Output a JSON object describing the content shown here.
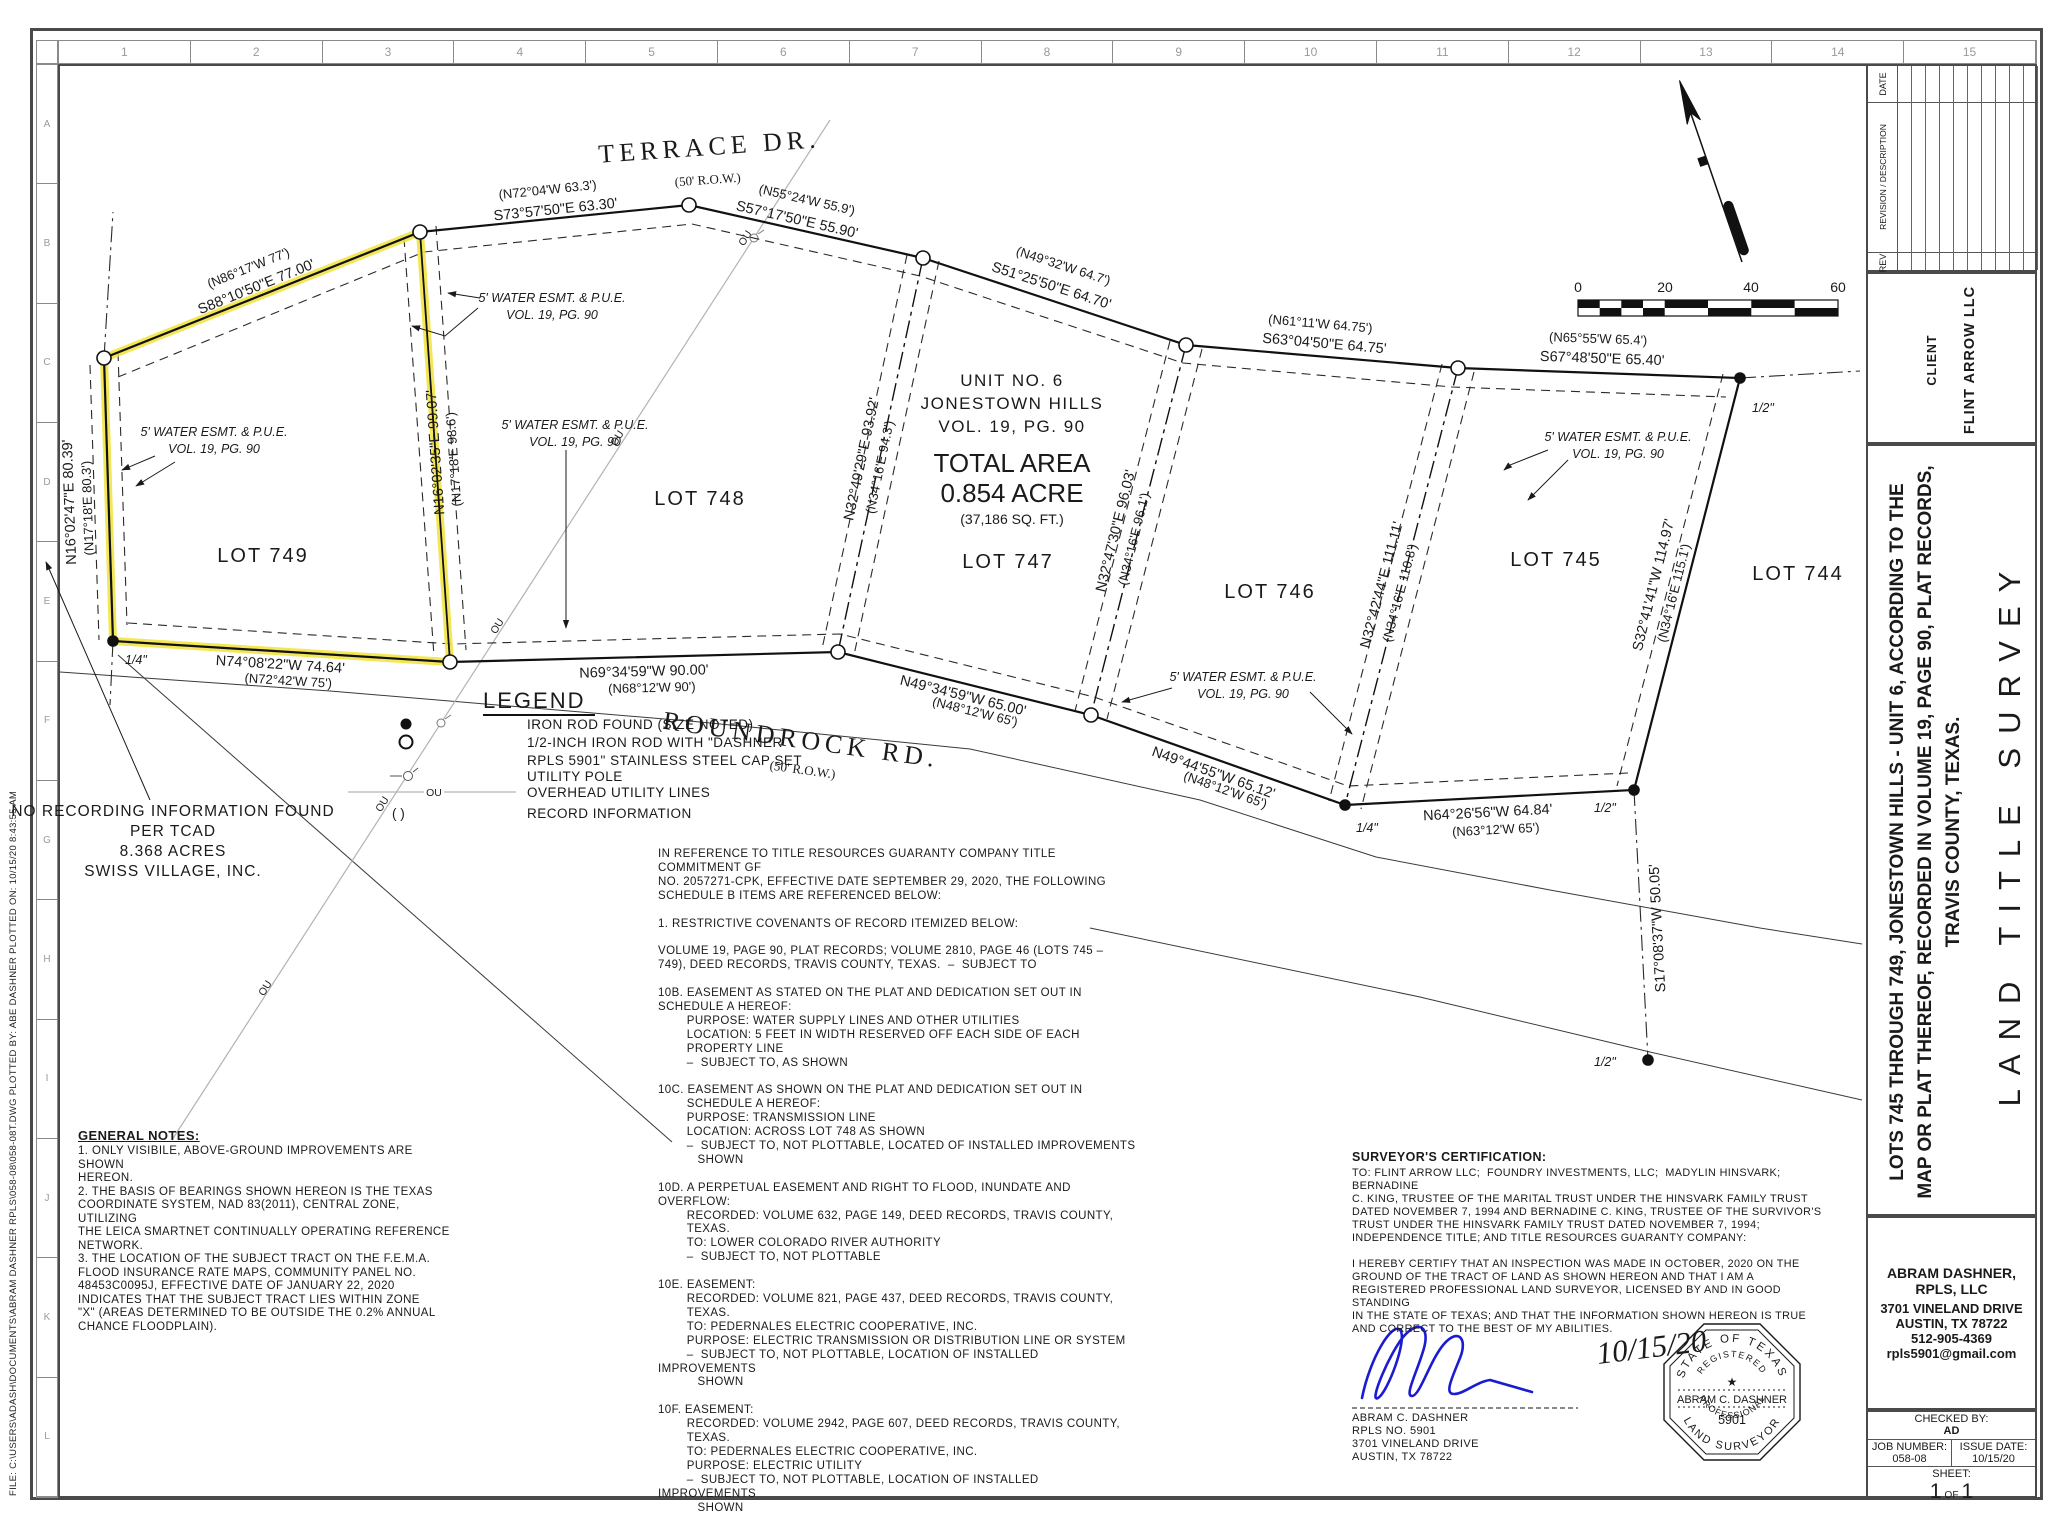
{
  "frame": {
    "margin_note": "FILE: C:\\USERS\\ADASH\\DOCUMENTS\\ABRAM DASHNER RPLS\\058-08\\058-08T.DWG      PLOTTED BY: ABE DASHNER      PLOTTED ON: 10/15/20  8:43:55 AM",
    "ruler_cols": [
      "1",
      "2",
      "3",
      "4",
      "5",
      "6",
      "7",
      "8",
      "9",
      "10",
      "11",
      "12",
      "13",
      "14",
      "15"
    ],
    "ruler_rows": [
      "A",
      "B",
      "C",
      "D",
      "E",
      "F",
      "G",
      "H",
      "I",
      "J",
      "K",
      "L"
    ]
  },
  "sidebar": {
    "revision": {
      "rev": "REV",
      "desc": "REVISION / DESCRIPTION",
      "date": "DATE"
    },
    "client_label": "CLIENT",
    "client_name": "FLINT ARROW LLC",
    "title_lines": [
      "LOTS 745 THROUGH 749, JONESTOWN HILLS - UNIT 6, ACCORDING TO THE",
      "MAP OR PLAT THEREOF, RECORDED IN VOLUME 19, PAGE 90, PLAT RECORDS,",
      "TRAVIS COUNTY, TEXAS."
    ],
    "survey_type": "LAND TITLE SURVEY",
    "firm": {
      "name": "ABRAM DASHNER, RPLS, LLC",
      "addr1": "3701 VINELAND DRIVE",
      "addr2": "AUSTIN, TX 78722",
      "phone": "512-905-4369",
      "email": "rpls5901@gmail.com"
    },
    "info": {
      "checked_label": "CHECKED BY:",
      "checked": "AD",
      "job_label": "JOB NUMBER:",
      "job": "058-08",
      "issue_label": "ISSUE DATE:",
      "issue": "10/15/20",
      "sheet_label": "SHEET:",
      "sheet_no": "1",
      "sheet_of": "OF",
      "sheet_total": "1"
    }
  },
  "plat": {
    "roads": {
      "terrace": "TERRACE DR.",
      "roundrock": "ROUNDROCK RD.",
      "row": "(50' R.O.W.)"
    },
    "unit": [
      "UNIT NO. 6",
      "JONESTOWN HILLS",
      "VOL. 19, PG. 90"
    ],
    "area": {
      "l1": "TOTAL AREA",
      "l2": "0.854 ACRE",
      "l3": "(37,186 SQ. FT.)"
    },
    "lots": {
      "l749": "LOT 749",
      "l748": "LOT 748",
      "l747": "LOT 747",
      "l746": "LOT 746",
      "l745": "LOT 745",
      "l744": "LOT 744"
    },
    "esmt": {
      "l1": "5' WATER ESMT. & P.U.E.",
      "l2": "VOL. 19, PG. 90"
    },
    "markers": {
      "q": "1/4\"",
      "h": "1/2\""
    },
    "ou": "OU",
    "no_rec": [
      "NO RECORDING INFORMATION FOUND",
      "PER TCAD",
      "8.368 ACRES",
      "SWISS VILLAGE, INC."
    ],
    "bearings": [
      {
        "m": "S88°10'50\"E  77.00'",
        "r": "(N86°17'W  77')"
      },
      {
        "m": "S73°57'50\"E  63.30'",
        "r": "(N72°04'W  63.3')"
      },
      {
        "m": "S57°17'50\"E  55.90'",
        "r": "(N55°24'W  55.9')"
      },
      {
        "m": "S51°25'50\"E  64.70'",
        "r": "(N49°32'W  64.7')"
      },
      {
        "m": "S63°04'50\"E  64.75'",
        "r": "(N61°11'W  64.75')"
      },
      {
        "m": "S67°48'50\"E  65.40'",
        "r": "(N65°55'W  65.4')"
      },
      {
        "m": "S32°41'41\"W  114.97'",
        "r": "(N34°16'E  115.1')"
      },
      {
        "m": "N64°26'56\"W  64.84'",
        "r": "(N63°12'W  65')"
      },
      {
        "m": "N49°44'55\"W  65.12'",
        "r": "(N48°12'W  65')"
      },
      {
        "m": "N49°34'59\"W  65.00'",
        "r": "(N48°12'W  65')"
      },
      {
        "m": "N69°34'59\"W  90.00'",
        "r": "(N68°12'W  90')"
      },
      {
        "m": "N74°08'22\"W  74.64'",
        "r": "(N72°42'W  75')"
      },
      {
        "m": "N16°02'47\"E  80.39'",
        "r": "(N17°18'E  80.3')"
      },
      {
        "m": "N16°02'35\"E  99.07'",
        "r": "(N17°18'E  98.6')"
      },
      {
        "m": "N32°49'29\"E  93.92'",
        "r": "(N34°16'E  94.3')"
      },
      {
        "m": "N32°47'30\"E  96.03'",
        "r": "(N34°16'E  96.1')"
      },
      {
        "m": "N32°42'44\"E  111.11'",
        "r": "(N34°16'E  110.8')"
      },
      {
        "m": "S17°08'37\"W  50.05'",
        "r": ""
      }
    ]
  },
  "legend": {
    "title": "LEGEND",
    "i0": "IRON ROD FOUND (SIZE NOTED)",
    "i1a": "1/2-INCH IRON ROD WITH \"DASHNER",
    "i1b": "RPLS 5901\" STAINLESS STEEL CAP SET",
    "i2": "UTILITY POLE",
    "i3": "OVERHEAD UTILITY LINES",
    "i4": "RECORD INFORMATION",
    "rec_sym": "(   )"
  },
  "notes": {
    "general_title": "GENERAL NOTES:",
    "general": "1. ONLY VISIBILE, ABOVE-GROUND IMPROVEMENTS ARE SHOWN\nHEREON.\n2. THE BASIS OF BEARINGS SHOWN HEREON IS THE TEXAS\nCOORDINATE SYSTEM, NAD 83(2011), CENTRAL ZONE, UTILIZING\nTHE LEICA SMARTNET CONTINUALLY OPERATING REFERENCE\nNETWORK.\n3. THE LOCATION OF THE SUBJECT TRACT ON THE F.E.M.A.\nFLOOD INSURANCE RATE MAPS, COMMUNITY PANEL NO.\n48453C0095J, EFFECTIVE DATE OF JANUARY 22, 2020\nINDICATES THAT THE SUBJECT TRACT LIES WITHIN ZONE\n\"X\" (AREAS DETERMINED TO BE OUTSIDE THE 0.2% ANNUAL\nCHANCE FLOODPLAIN).",
    "schedule_b": "IN REFERENCE TO TITLE RESOURCES GUARANTY COMPANY TITLE COMMITMENT GF\nNO. 2057271-CPK, EFFECTIVE DATE SEPTEMBER 29, 2020, THE FOLLOWING\nSCHEDULE B ITEMS ARE REFERENCED BELOW:\n\n1. RESTRICTIVE COVENANTS OF RECORD ITEMIZED BELOW:\n\nVOLUME 19, PAGE 90, PLAT RECORDS; VOLUME 2810, PAGE 46 (LOTS 745 –\n749), DEED RECORDS, TRAVIS COUNTY, TEXAS.  –  SUBJECT TO\n\n10B. EASEMENT AS STATED ON THE PLAT AND DEDICATION SET OUT IN\nSCHEDULE A HEREOF:\n        PURPOSE: WATER SUPPLY LINES AND OTHER UTILITIES\n        LOCATION: 5 FEET IN WIDTH RESERVED OFF EACH SIDE OF EACH\n        PROPERTY LINE\n        –  SUBJECT TO, AS SHOWN\n\n10C. EASEMENT AS SHOWN ON THE PLAT AND DEDICATION SET OUT IN\n        SCHEDULE A HEREOF:\n        PURPOSE: TRANSMISSION LINE\n        LOCATION: ACROSS LOT 748 AS SHOWN\n        –  SUBJECT TO, NOT PLOTTABLE, LOCATED OF INSTALLED IMPROVEMENTS\n           SHOWN\n\n10D. A PERPETUAL EASEMENT AND RIGHT TO FLOOD, INUNDATE AND\nOVERFLOW:\n        RECORDED: VOLUME 632, PAGE 149, DEED RECORDS, TRAVIS COUNTY,\n        TEXAS.\n        TO: LOWER COLORADO RIVER AUTHORITY\n        –  SUBJECT TO, NOT PLOTTABLE\n\n10E. EASEMENT:\n        RECORDED: VOLUME 821, PAGE 437, DEED RECORDS, TRAVIS COUNTY,\n        TEXAS.\n        TO: PEDERNALES ELECTRIC COOPERATIVE, INC.\n        PURPOSE: ELECTRIC TRANSMISSION OR DISTRIBUTION LINE OR SYSTEM\n        –  SUBJECT TO, NOT PLOTTABLE, LOCATION OF INSTALLED IMPROVEMENTS\n           SHOWN\n\n10F. EASEMENT:\n        RECORDED: VOLUME 2942, PAGE 607, DEED RECORDS, TRAVIS COUNTY,\n        TEXAS.\n        TO: PEDERNALES ELECTRIC COOPERATIVE, INC.\n        PURPOSE: ELECTRIC UTILITY\n        –  SUBJECT TO, NOT PLOTTABLE, LOCATION OF INSTALLED IMPROVEMENTS\n           SHOWN"
  },
  "cert": {
    "title": "SURVEYOR'S CERTIFICATION:",
    "to": "TO: FLINT ARROW LLC;  FOUNDRY INVESTMENTS, LLC;  MADYLIN HINSVARK;  BERNADINE\nC. KING, TRUSTEE OF THE MARITAL TRUST UNDER THE HINSVARK FAMILY TRUST\nDATED NOVEMBER 7, 1994 AND BERNADINE C. KING, TRUSTEE OF THE SURVIVOR'S\nTRUST UNDER THE HINSVARK FAMILY TRUST DATED NOVEMBER 7, 1994;\nINDEPENDENCE TITLE; AND TITLE RESOURCES GUARANTY COMPANY:",
    "body": "I HEREBY CERTIFY THAT AN INSPECTION WAS MADE IN OCTOBER, 2020 ON THE\nGROUND OF THE TRACT OF LAND AS SHOWN HEREON AND THAT I AM A\nREGISTERED PROFESSIONAL LAND SURVEYOR, LICENSED BY AND IN GOOD STANDING\nIN THE STATE OF TEXAS; AND THAT THE INFORMATION SHOWN HEREON IS TRUE\nAND CORRECT TO THE BEST OF MY ABILITIES.",
    "name": "ABRAM C. DASHNER",
    "rpls": "RPLS NO. 5901",
    "addr1": "3701 VINELAND DRIVE",
    "addr2": "AUSTIN, TX 78722",
    "date": "10/15/20"
  },
  "seal": {
    "arc_top": "STATE OF TEXAS",
    "arc_top2": "REGISTERED",
    "star": "★",
    "name": "ABRAM C. DASHNER",
    "number": "5901",
    "arc_bot1": "PROFESSIONAL",
    "arc_bot2": "LAND SURVEYOR"
  },
  "scalebar": {
    "t0": "0",
    "t20": "20",
    "t40": "40",
    "t60": "60"
  }
}
